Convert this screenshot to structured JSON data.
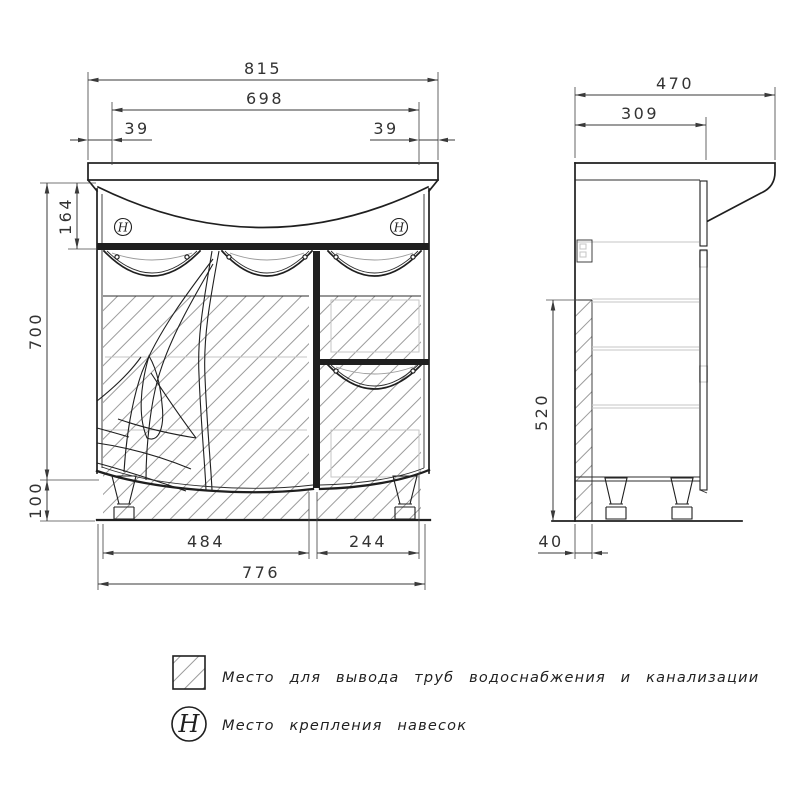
{
  "front_view": {
    "dim_total_width": "815",
    "dim_basin_width": "698",
    "dim_offset_left": "39",
    "dim_offset_right": "39",
    "dim_apron_height": "164",
    "dim_body_height": "700",
    "dim_leg_height": "100",
    "dim_doors_width": "484",
    "dim_drawers_width": "244",
    "dim_cabinet_width": "776"
  },
  "side_view": {
    "dim_total_depth": "470",
    "dim_body_depth": "309",
    "dim_service_height": "520",
    "dim_service_depth": "40"
  },
  "legend": {
    "h_symbol": "H",
    "items": [
      {
        "symbol": "hatch-square",
        "label": "Место для вывода труб водоснабжения и канализации"
      },
      {
        "symbol": "h-circle",
        "label": "Место крепления навесок"
      }
    ]
  },
  "colors": {
    "line": "#1f1f1f",
    "dimension": "#3a3a3a",
    "hatch": "#9b9b9b",
    "faint_detail": "#c6c6c6",
    "background": "#ffffff"
  }
}
